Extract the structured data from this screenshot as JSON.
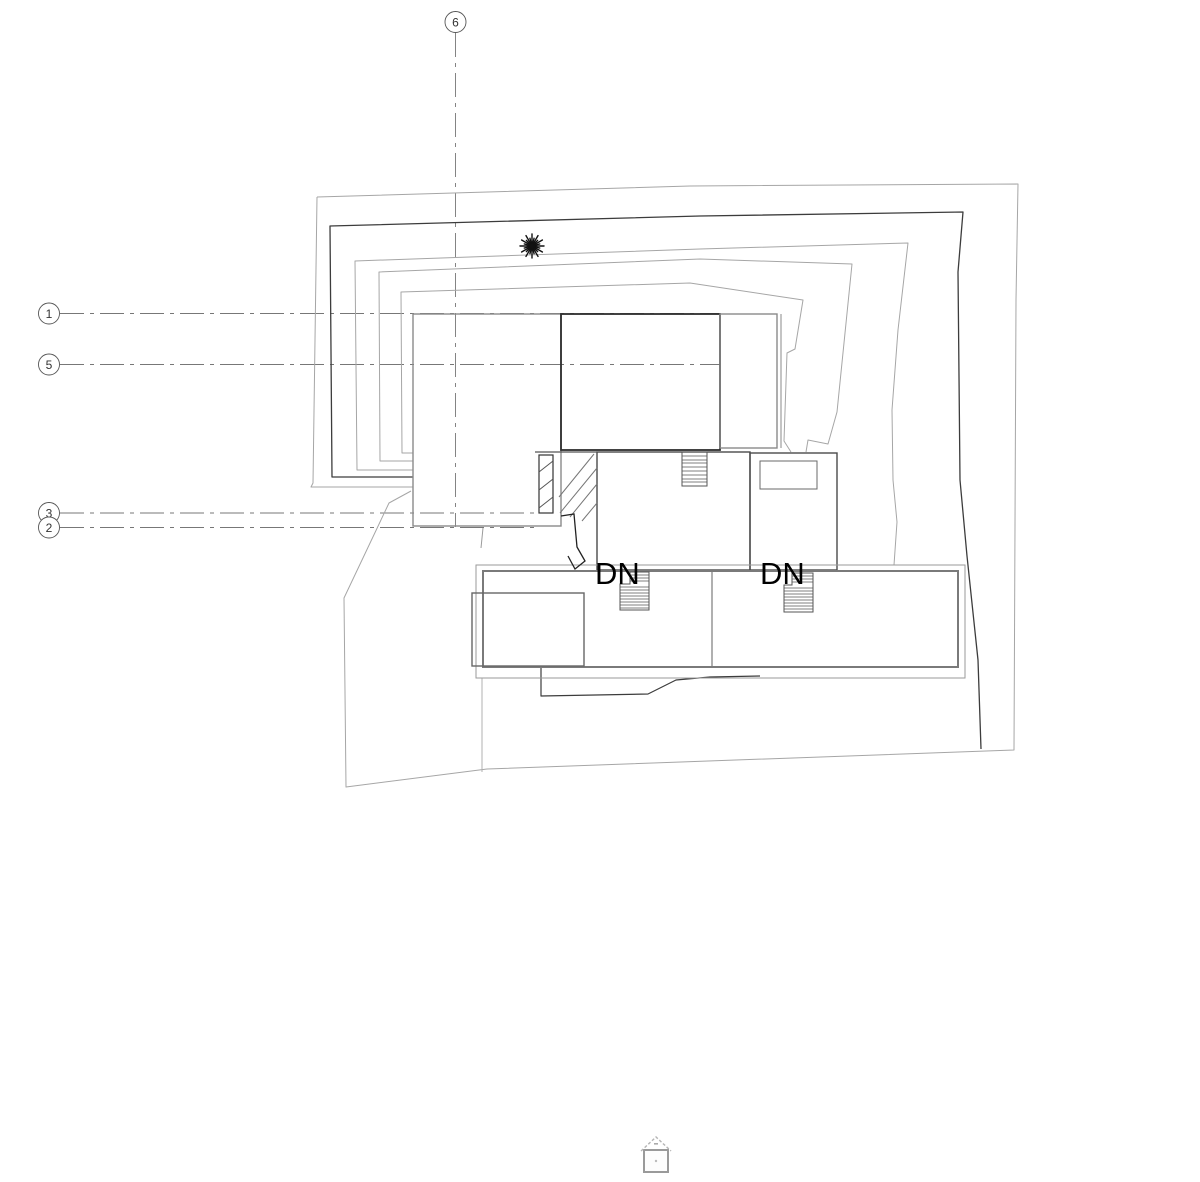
{
  "drawing": {
    "kind": "architectural roof / site plan",
    "grid_bubbles": {
      "g6": "6",
      "g1": "1",
      "g5": "5",
      "g3": "3",
      "g2": "2"
    },
    "annotations": {
      "dn_left": "DN",
      "dn_right": "DN"
    },
    "symbols": [
      "tree-icon",
      "house-marker-icon",
      "stair-icon"
    ],
    "colors": {
      "background": "#ffffff",
      "line_light": "#a6a6a6",
      "line_mid": "#707070",
      "line_dark": "#383838",
      "grid_line": "#777777",
      "text": "#000000"
    }
  }
}
